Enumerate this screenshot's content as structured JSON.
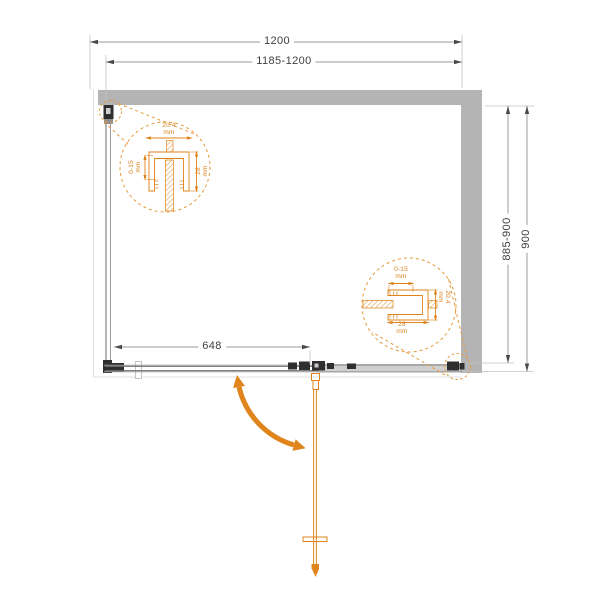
{
  "drawing": {
    "dimensions": {
      "width_total": "1200",
      "width_range": "1185-1200",
      "depth_total": "900",
      "depth_range": "885-900",
      "fixed_panel_width": "648"
    },
    "detail_top_left": {
      "profile_width": "20.4\nmm",
      "adjustment_range": "0-15\nmm",
      "profile_depth": "28\nmm"
    },
    "detail_bottom_right": {
      "adjustment_range": "0-15\nmm",
      "profile_width": "20.4\nmm",
      "profile_depth": "28\nmm"
    },
    "colors": {
      "accent_orange": "#DF851C",
      "wall_gray": "#B4B4B4",
      "dimension_line_gray": "#9B9B9B",
      "text_dark": "#3F3F3F"
    }
  }
}
